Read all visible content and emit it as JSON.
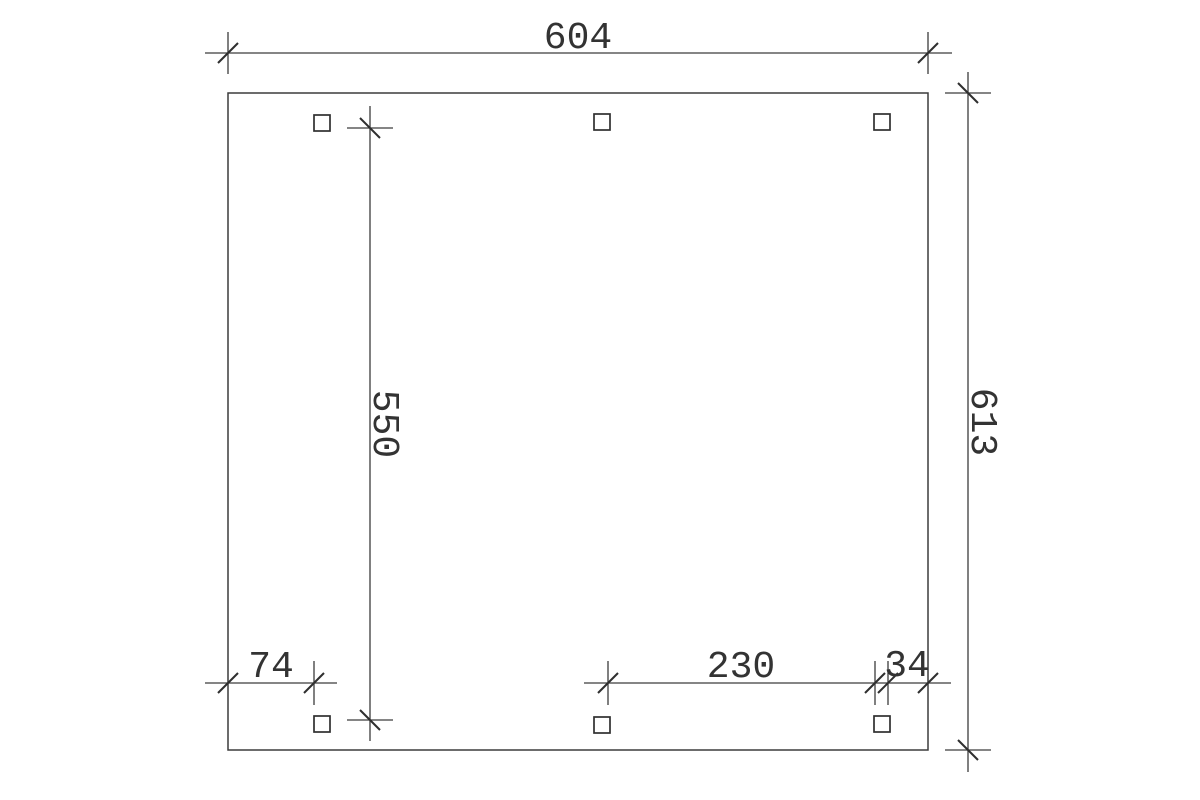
{
  "drawing": {
    "background_color": "#ffffff",
    "line_color": "#3c3c3c",
    "text_color": "#333333",
    "dimensions": {
      "top_width": "604",
      "right_height": "613",
      "inner_post_spacing": "550",
      "bottom_left_offset": "74",
      "bottom_post_spacing": "230",
      "bottom_right_offset": "34"
    },
    "posts": {
      "count": 6
    }
  }
}
